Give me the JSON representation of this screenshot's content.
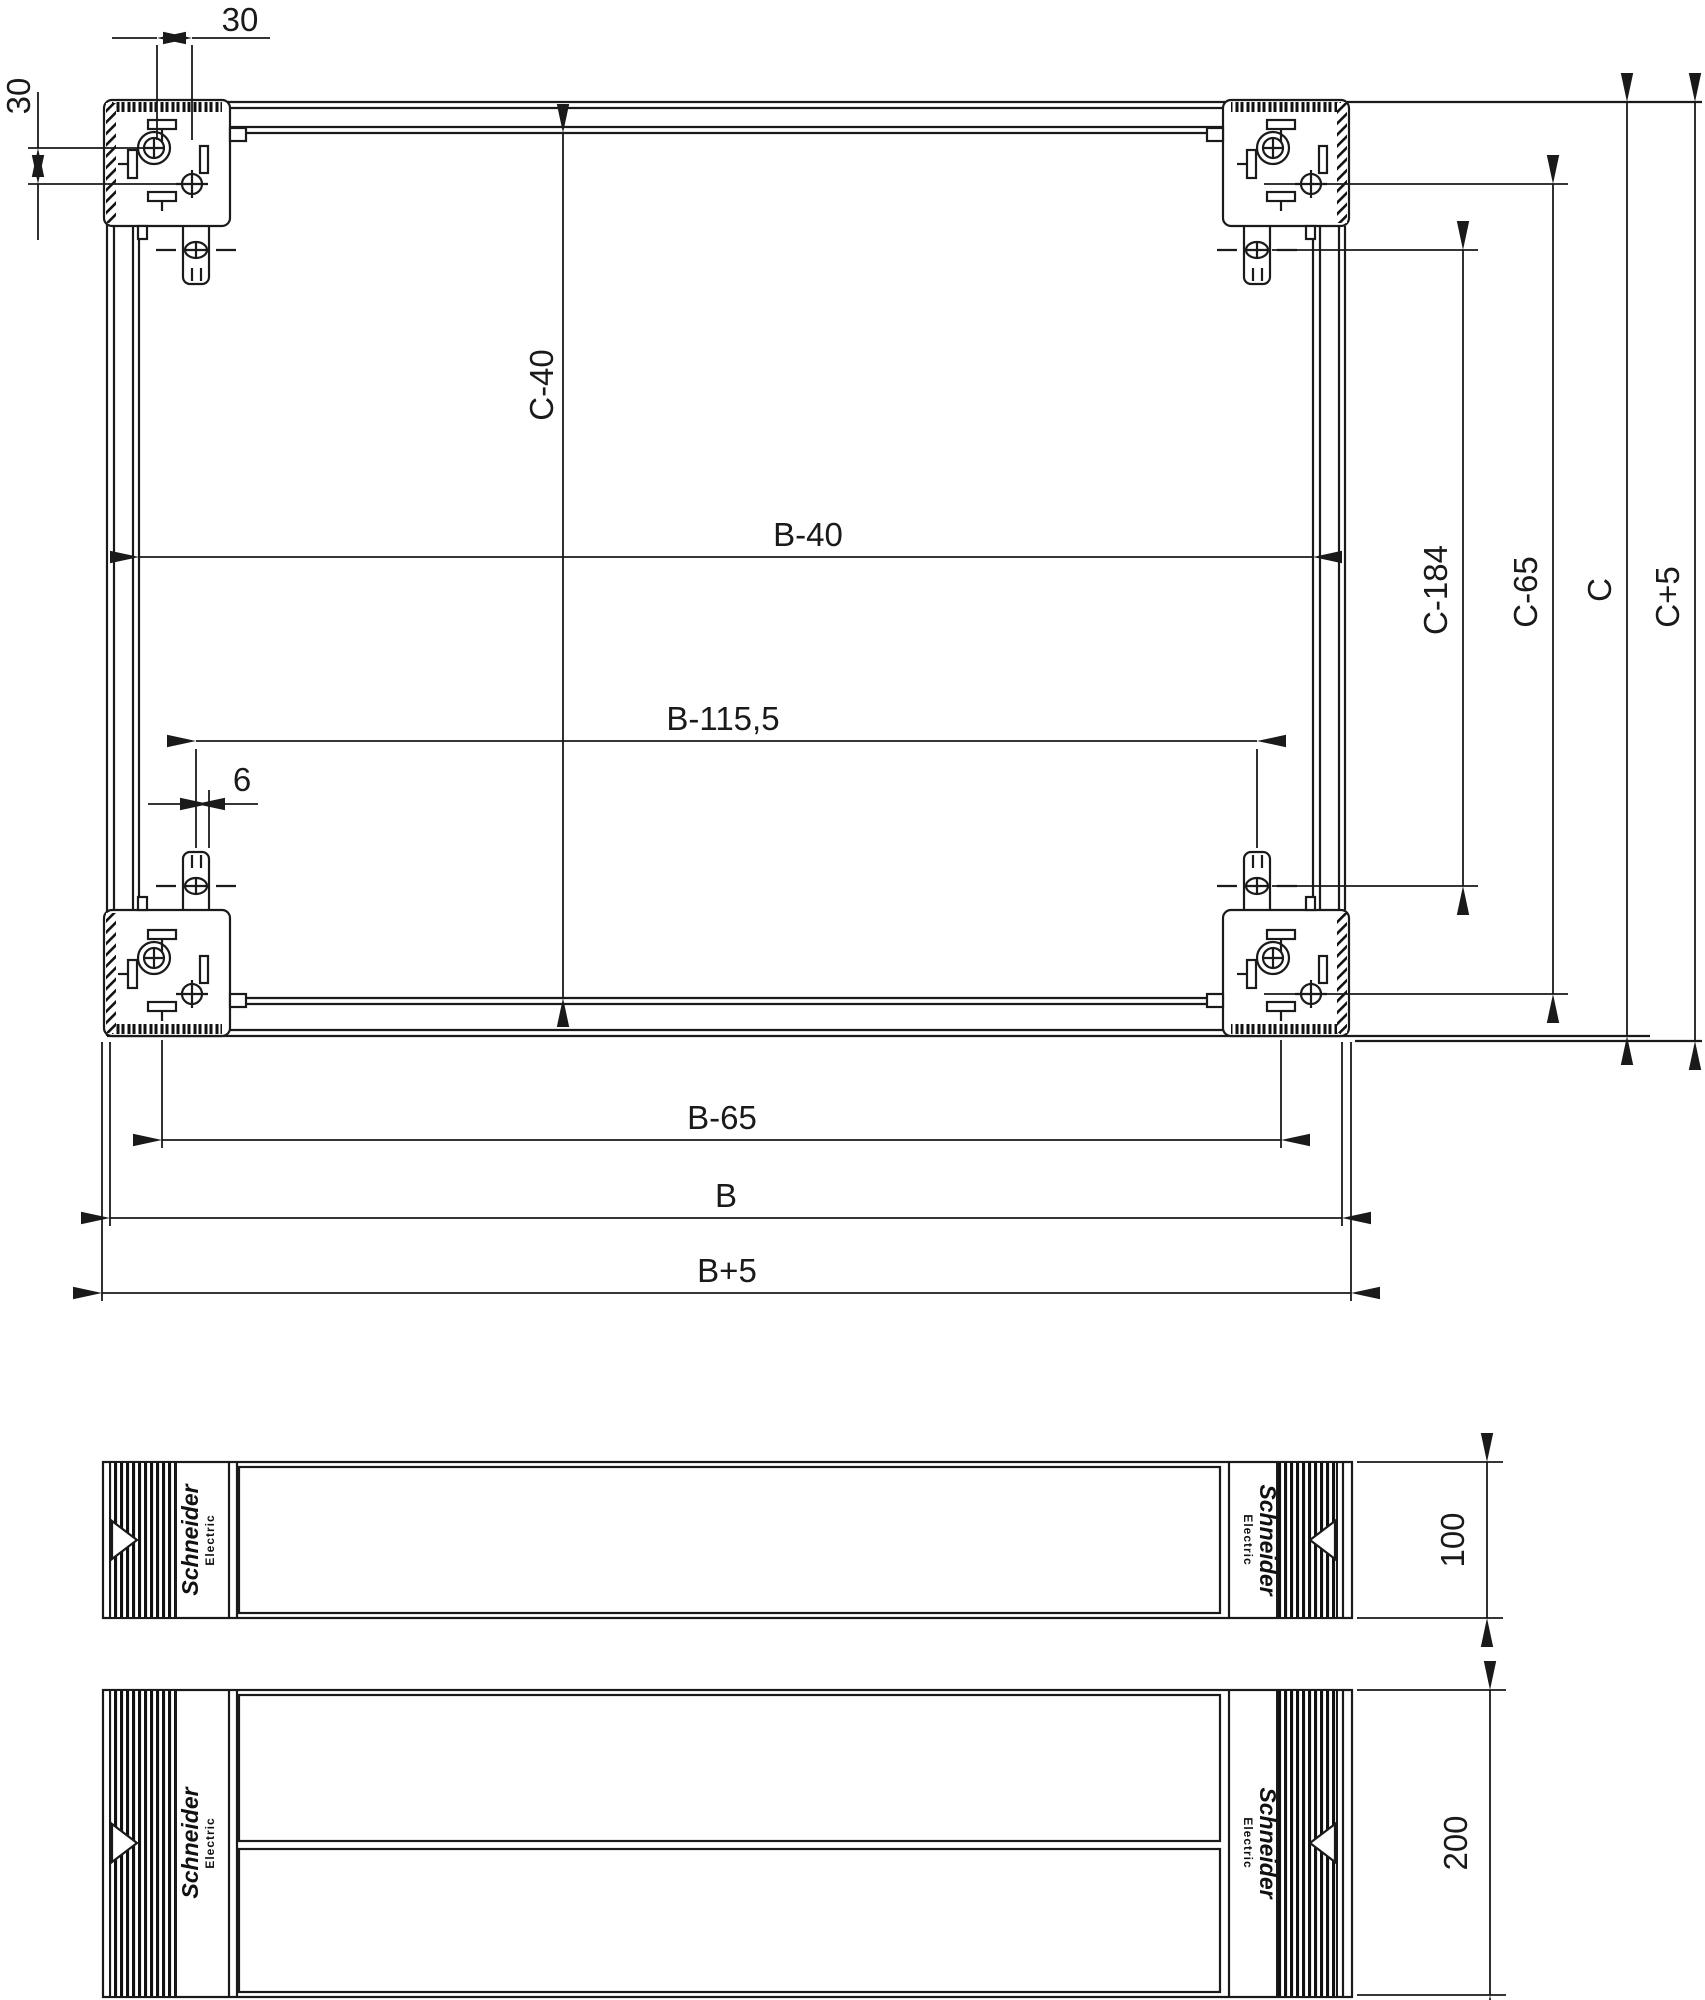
{
  "drawing": {
    "colors": {
      "line": "#1a1a1a",
      "background": "#ffffff"
    },
    "dimensions": {
      "top_offset": "30",
      "left_offset": "30",
      "c_minus_40": "C-40",
      "b_minus_40": "B-40",
      "b_minus_115_5": "B-115,5",
      "offset_6": "6",
      "c_minus_184": "C-184",
      "c_minus_65": "C-65",
      "c": "C",
      "c_plus_5": "C+5",
      "b_minus_65": "B-65",
      "b": "B",
      "b_plus_5": "B+5",
      "plinth_front_height_small": "100",
      "plinth_front_height_large": "200"
    },
    "brand": {
      "line1": "Schneider",
      "line2": "Electric"
    }
  }
}
